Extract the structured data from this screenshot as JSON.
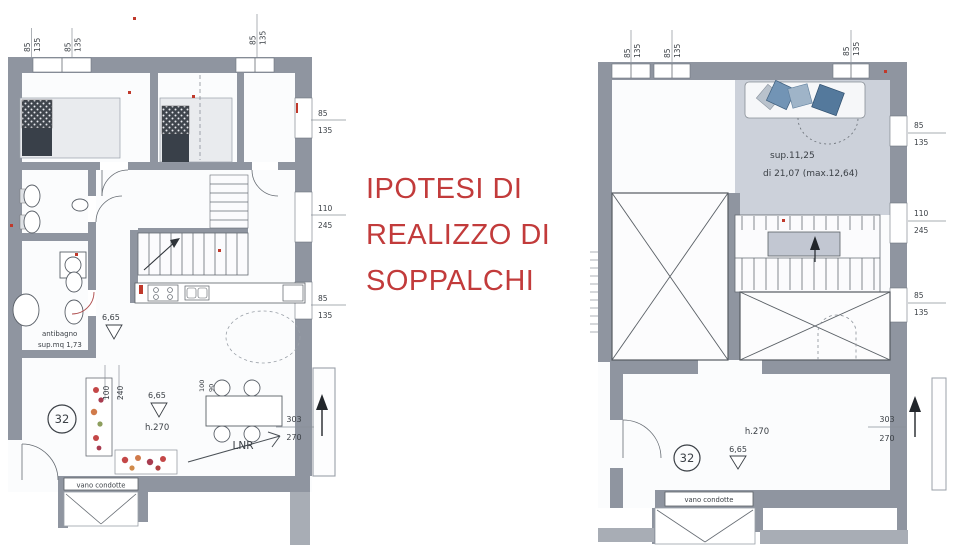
{
  "annotation": {
    "line1": "IPOTESI DI",
    "line2": "REALIZZO DI",
    "line3": "SOPPALCHI"
  },
  "left_plan": {
    "unit_number": "32",
    "antibagno_label": "antibagno",
    "antibagno_area": "sup.mq 1,73",
    "corridor_level": "6,65",
    "living_level": "6,65",
    "room_height": "h.270",
    "table_label": "LNR",
    "duct_label": "vano condotte",
    "dims": {
      "top_left": [
        "85",
        "135",
        "85",
        "135"
      ],
      "top_right": [
        "85",
        "135"
      ],
      "right_upper": [
        "85",
        "135"
      ],
      "right_middle": [
        "110",
        "245"
      ],
      "right_lower": [
        "85",
        "135"
      ],
      "living_width": [
        "100",
        "240"
      ],
      "table": [
        "100",
        "90"
      ],
      "door_bottom": [
        "303",
        "270"
      ]
    }
  },
  "right_plan": {
    "unit_number": "32",
    "mezzanine_area_line1": "sup.11,25",
    "mezzanine_area_line2": "di 21,07 (max.12,64)",
    "living_level": "6,65",
    "room_height": "h.270",
    "duct_label": "vano condotte",
    "dims": {
      "top_left": [
        "85",
        "135",
        "85",
        "135"
      ],
      "top_right": [
        "85",
        "135"
      ],
      "right_upper": [
        "85",
        "135"
      ],
      "right_middle": [
        "110",
        "245"
      ],
      "right_lower": [
        "85",
        "135"
      ],
      "door_bottom": [
        "303",
        "270"
      ]
    }
  },
  "colors": {
    "annotation_red": "#c23b3b",
    "wall_gray": "#8f95a0",
    "mezzanine_shade": "#c7ccd6",
    "cushion_blue": "#54799c"
  }
}
